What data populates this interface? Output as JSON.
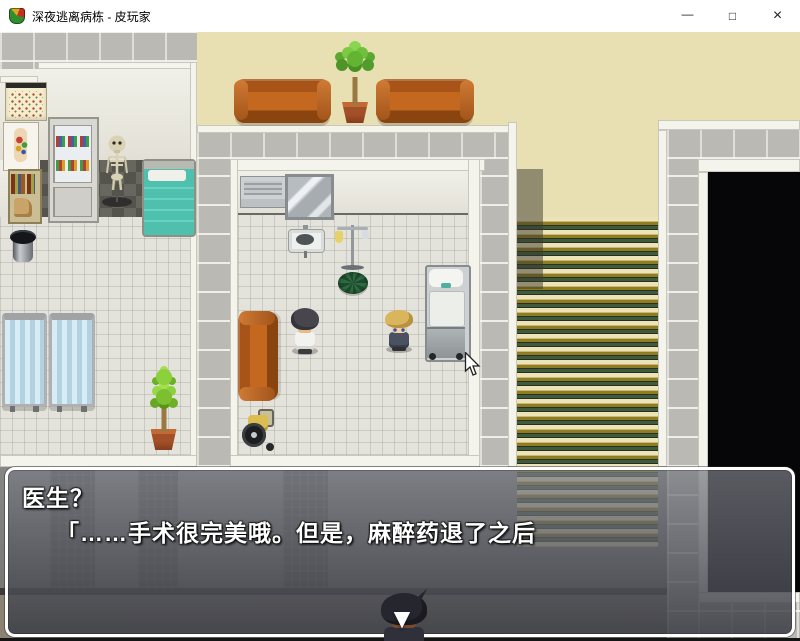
{
  "window": {
    "title": "深夜逃离病栋 - 皮玩家",
    "controls": {
      "minimize": "—",
      "maximize": "□",
      "close": "×"
    }
  },
  "dialogue": {
    "line1": "医生？",
    "line2": "「……手术很完美哦。但是，麻醉药退了之后",
    "continue_indicator": "▼"
  },
  "scene": {
    "colors": {
      "wall_beige": "#e8dfb2",
      "brick_gray": "#bab9b3",
      "tile_floor": "#e4e3db",
      "dark_tile": "#5e5e56",
      "khaki_floor": "#8b8273",
      "couch_brown": "#b35c1e",
      "bed_teal": "#4fc0ae",
      "stair_gold": "#8f7d22",
      "stair_green": "#3d5c3c",
      "dark_room": "#060608",
      "dialog_border": "#ffffff"
    }
  }
}
